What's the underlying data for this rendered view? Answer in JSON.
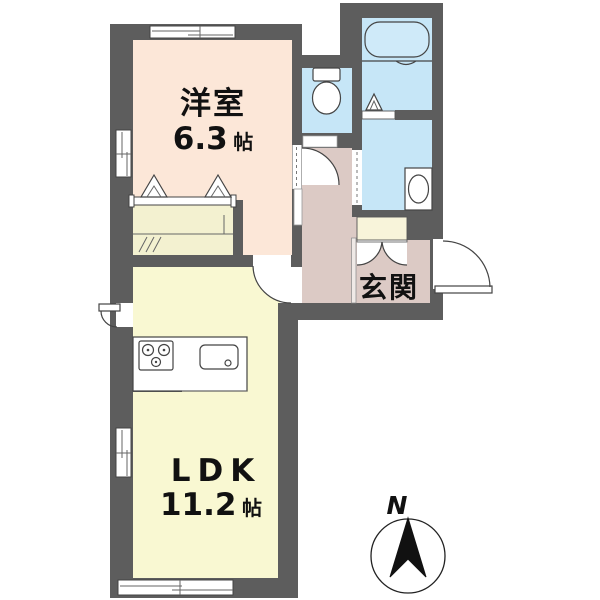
{
  "plan_title": "1LDK floor plan",
  "rooms": {
    "western_room": {
      "label": "洋室",
      "size_value": "6.3",
      "size_unit": "帖",
      "fill": "#fce7d8"
    },
    "ldk": {
      "label": "LDK",
      "size_value": "11.2",
      "size_unit": "帖",
      "fill": "#f9f8d2"
    },
    "genkan": {
      "label": "玄関",
      "fill": "#dccac5"
    },
    "hallway": {
      "fill": "#dccac5"
    },
    "bathroom": {
      "fill": "#c6e6f7"
    },
    "washroom": {
      "fill": "#c6e6f7"
    },
    "toilet": {
      "fill": "#c6e6f7"
    },
    "closet": {
      "fill": "#f3f1d0"
    },
    "shoe_cabinet": {
      "fill": "#f8f4da"
    }
  },
  "walls": {
    "color": "#5d5d5d"
  },
  "bathtub_fill": "#cfeaf9",
  "compass": {
    "north_label": "N"
  },
  "fixtures": [
    "bathtub",
    "toilet-bowl",
    "washbasin",
    "kitchen-counter",
    "kitchen-stove",
    "kitchen-sink",
    "closet-folding-doors",
    "bath-folding-door",
    "shoe-cabinet-double-doors",
    "entrance-swing-door",
    "service-door",
    "sliding-windows",
    "north-compass"
  ]
}
